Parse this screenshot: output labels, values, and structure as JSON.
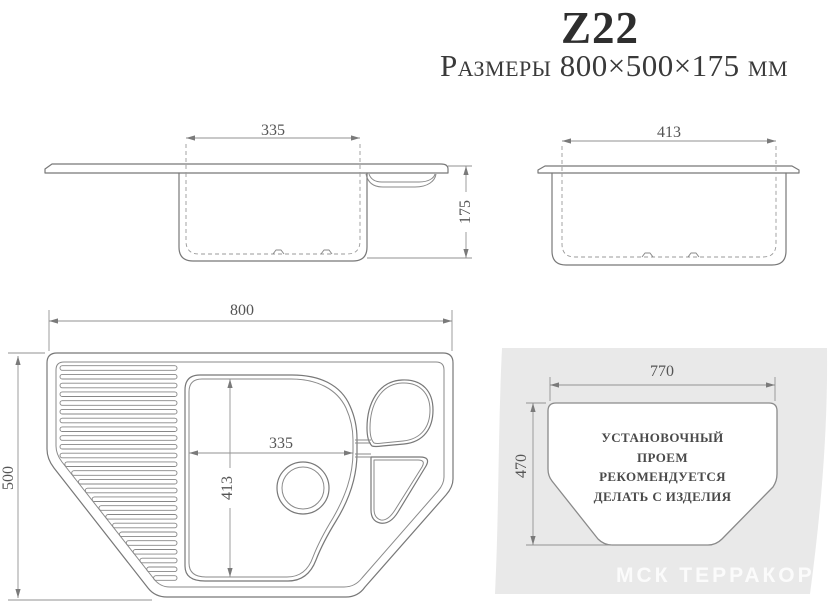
{
  "header": {
    "model": "Z22",
    "dimensions_label": "Размеры 800×500×175 мм"
  },
  "views": {
    "side_front": {
      "bowl_width": "335",
      "depth": "175"
    },
    "side_profile": {
      "bowl_width": "413"
    },
    "top": {
      "overall_width": "800",
      "overall_depth": "500",
      "bowl_width": "335",
      "bowl_depth": "413"
    },
    "cutout": {
      "width": "770",
      "depth": "470",
      "note_lines": [
        "УСТАНОВОЧНЫЙ",
        "ПРОЕМ",
        "РЕКОМЕНДУЕТСЯ",
        "ДЕЛАТЬ С ИЗДЕЛИЯ"
      ]
    }
  },
  "watermark": {
    "text": "МСК ТЕРРАКОРД"
  },
  "colors": {
    "line": "#787878",
    "dimension_line": "#929292",
    "countertop_band": "#e9e9e9",
    "watermark_text": "#f5f5f5",
    "text": "#3a3a3a"
  }
}
